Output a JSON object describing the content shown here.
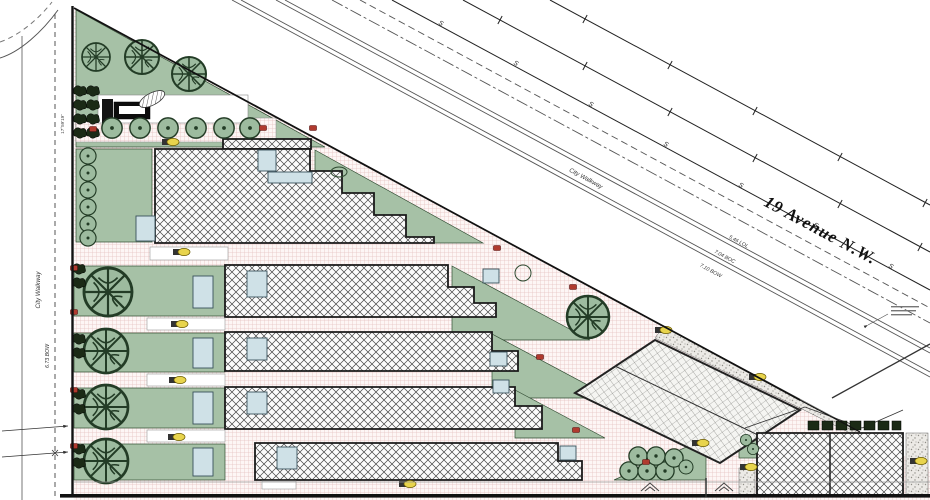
{
  "labels": {
    "street": "19 Avenue N.W.",
    "city_walkway_diag": "City Walkway",
    "city_walkway_left": "City Walkway",
    "bow_left": "6.73 BOW",
    "dim_left": "17°59'19\"",
    "offset1": "5.46 LOL",
    "offset2": "7.04 BOC",
    "offset3": "7.10 BOW",
    "s_marker": "S"
  },
  "colors": {
    "green": "#a6c1a6",
    "green2": "#9dbb9f",
    "gdark": "#233c26",
    "pinkline": "#e6c3c1",
    "pinkbg": "#fdf6f5",
    "hatchc": "#454545",
    "blue": "#cfe1e7",
    "lamp": "#e8d44d",
    "red": "#b03a2e",
    "gravelbg": "#eceae6",
    "dot": "#8f8d86",
    "ink": "#1a1a1a"
  }
}
